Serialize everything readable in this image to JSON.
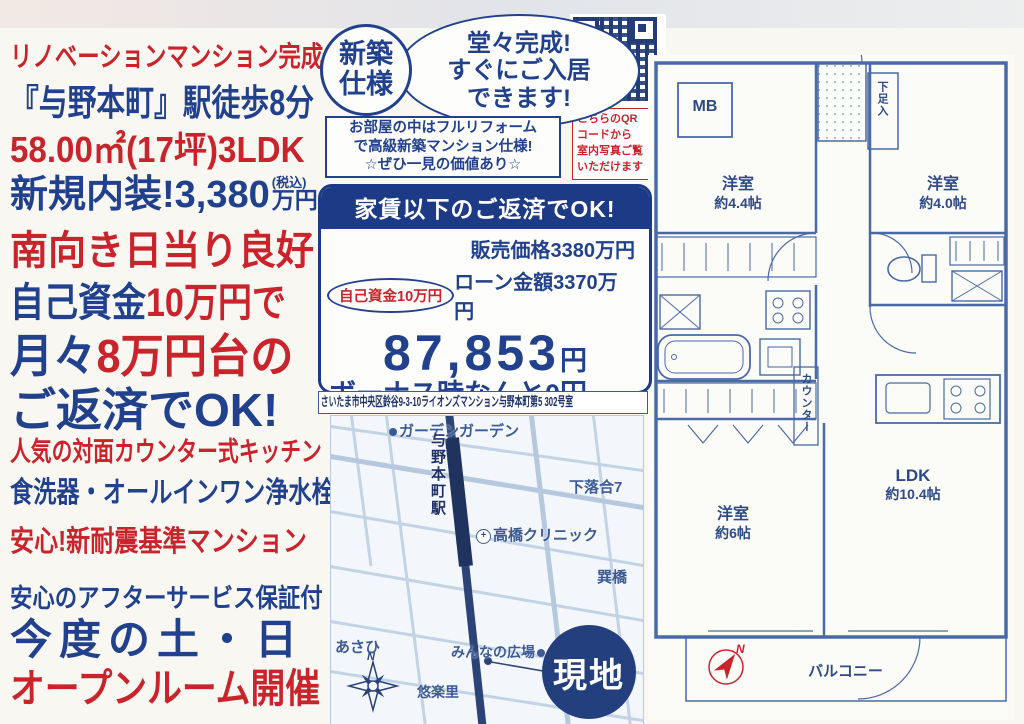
{
  "colors": {
    "red": "#c9242c",
    "blue": "#21418d",
    "navy_band": "#1d3a86",
    "map_ink": "#3c5a94",
    "plan_ink": "#4a6aa5"
  },
  "flyer": {
    "headline1": "リノベーションマンション完成",
    "headline2": "『与野本町』駅徒歩8分",
    "headline3": "58.00㎡(17坪)3LDK",
    "headline4_main": "新規内装!3,380",
    "headline4_tax": "(税込)",
    "headline4_unit": "万円",
    "headline5": "南向き日当り良好",
    "headline6_a": "自己資金",
    "headline6_b": "10万円で",
    "headline7_a": "月々",
    "headline7_b": "8万円台の",
    "headline8": "ご返済でOK!",
    "headline9": "人気の対面カウンター式キッチン",
    "headline10": "食洗器・オールインワン浄水栓",
    "headline11": "安心!新耐震基準マンション",
    "headline12": "安心のアフターサービス保証付",
    "headline13": "今度の土・日",
    "headline14": "オープンルーム開催"
  },
  "badge": {
    "line1": "新築",
    "line2": "仕様"
  },
  "bubble": {
    "line1": "堂々完成!",
    "line2": "すぐにご入居",
    "line3": "できます!"
  },
  "reform_note": {
    "line1": "お部屋の中はフルリフォーム",
    "line2": "で高級新築マンション仕様!",
    "line3": "☆ぜひ一見の価値あり☆"
  },
  "qr_caption": {
    "line1": "こちらのQR",
    "line2": "コードから",
    "line3": "室内写真ご覧",
    "line4": "いただけます"
  },
  "price_box": {
    "header": "家賃以下のご返済でOK!",
    "sale_price": "販売価格3380万円",
    "own_funds": "自己資金10万円",
    "loan_amount": "ローン金額3370万円",
    "monthly_amount": "87,853",
    "monthly_unit": "円",
    "bonus_line": "ボーナス時なんと0円",
    "rate_note": "0.525%(優遇金利適用の場合) 借入期間 35 年",
    "condition_note": "※優遇金利の適用には条件があります。"
  },
  "address": "さいたま市中央区鈴谷9-3-10ライオンズマンション与野本町第5 302号室",
  "map": {
    "garden": "ガーデンガーデン",
    "station": "与野本町駅",
    "shimoochiai": "下落合7",
    "clinic": "高橋クリニック",
    "bridge": "巽橋",
    "asahi": "あさひ",
    "plaza": "みんなの広場",
    "yurakuri": "悠楽里",
    "site": "現地",
    "compass_n": "N"
  },
  "floorplan": {
    "mb": "MB",
    "room1_name": "洋室",
    "room1_size": "約4.4帖",
    "room2_name": "洋室",
    "room2_size": "約4.0帖",
    "entry_closet": "下足入",
    "counter": "カウンター",
    "room3_name": "洋室",
    "room3_size": "約6帖",
    "ldk_name": "LDK",
    "ldk_size": "約10.4帖",
    "balcony": "バルコニー",
    "compass_n": "N"
  }
}
